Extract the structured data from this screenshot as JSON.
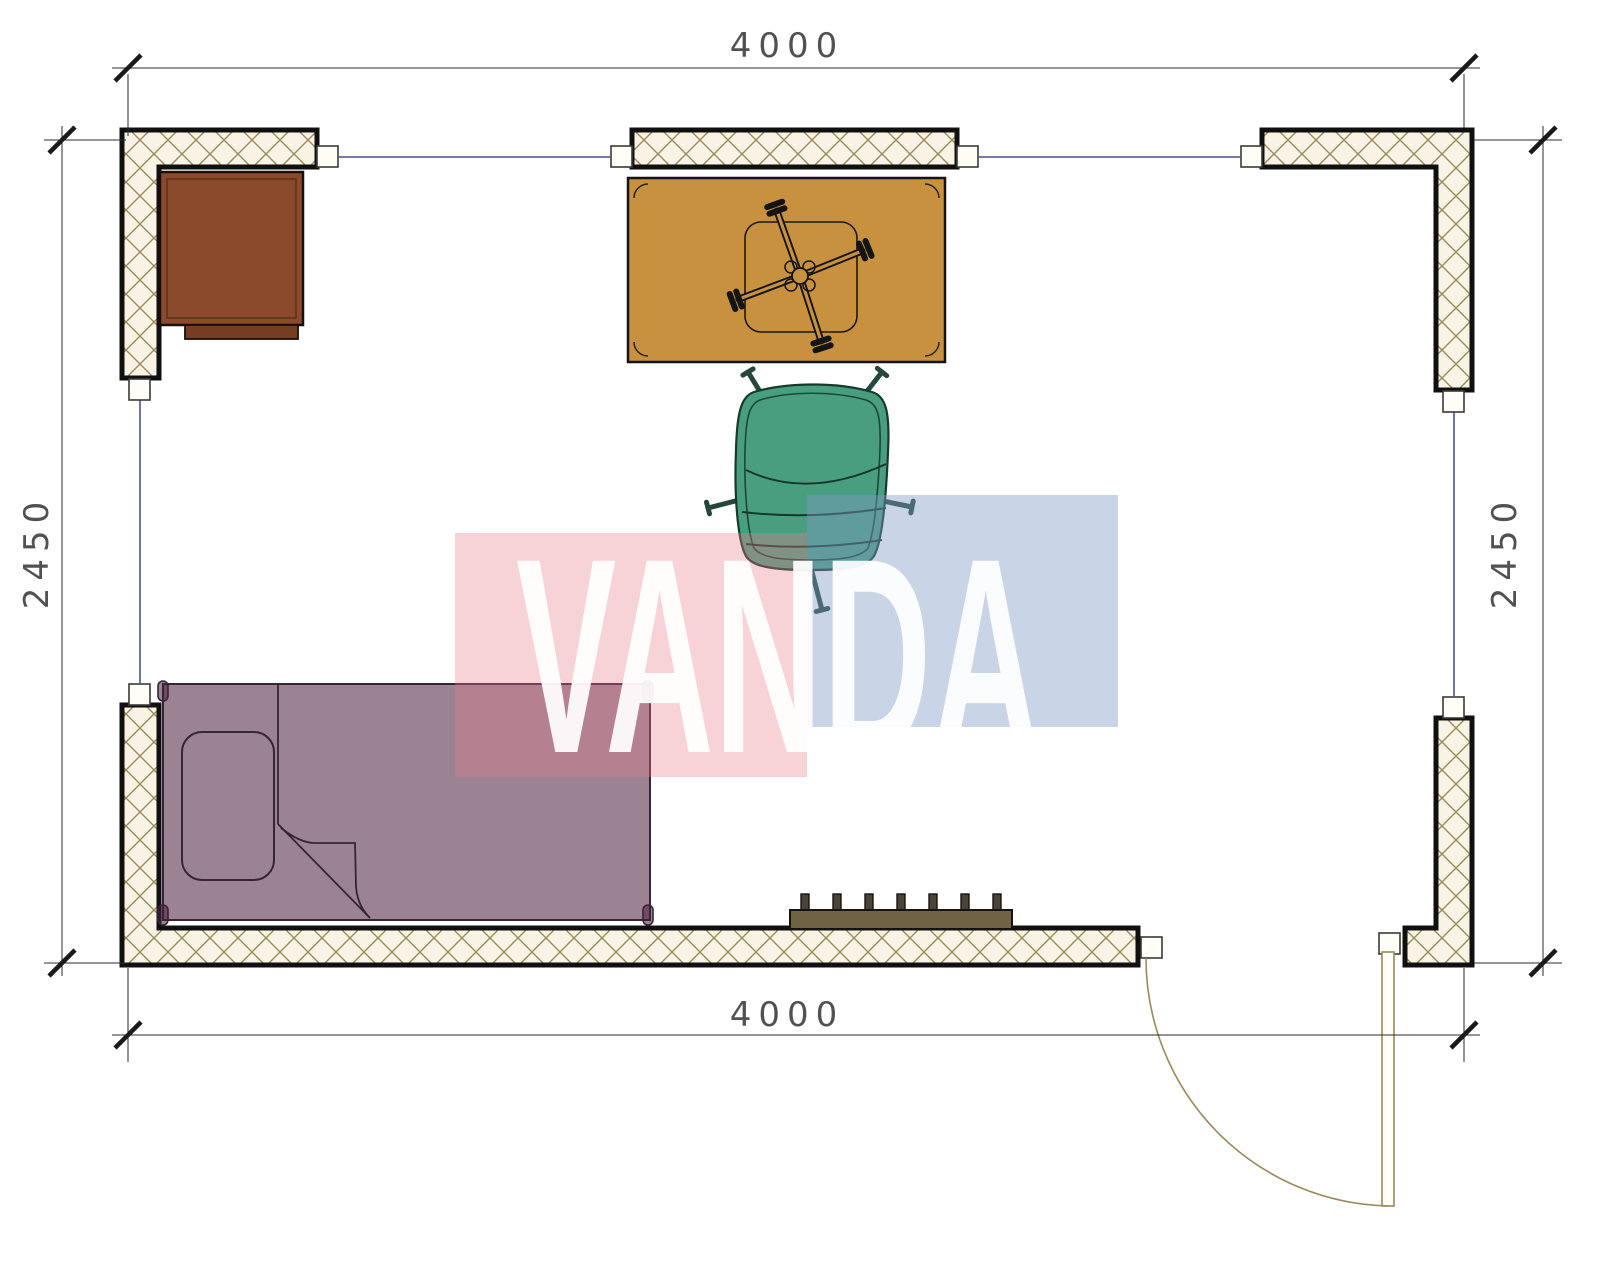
{
  "drawing": {
    "kind": "room floor plan",
    "room_width_label": "4000",
    "room_height_label": "2450"
  },
  "dimensions": {
    "top": "4000",
    "bottom": "4000",
    "left": "2450",
    "right": "2450"
  },
  "watermark": {
    "text": "VANDA",
    "pink": "#e97a8a",
    "blue": "#7f9cc6"
  },
  "colors": {
    "wall_outline": "#101010",
    "wall_fill": "#f8f3e4",
    "wall_hatch": "#9b8a5c",
    "axis_line": "#28286e",
    "dim_line": "#3a3a3a",
    "cap_fill": "#fffdf5",
    "cabinet": "#8c4a2c",
    "cabinet_drawer": "#773d24",
    "table": "#c79140",
    "chair": "#4a9e80",
    "chair_line": "#14382a",
    "bed": "#4a1e3a",
    "bed_line": "#352535",
    "radiator": "#6f6245",
    "radiator_fin": "#4a4438",
    "door": "#9a8a5a"
  },
  "furniture": [
    {
      "id": "cabinet",
      "label": "corner cabinet"
    },
    {
      "id": "table",
      "label": "table with cross base"
    },
    {
      "id": "office-chair",
      "label": "office chair"
    },
    {
      "id": "bed",
      "label": "single bed"
    },
    {
      "id": "radiator",
      "label": "radiator"
    },
    {
      "id": "door",
      "label": "swing door"
    }
  ]
}
